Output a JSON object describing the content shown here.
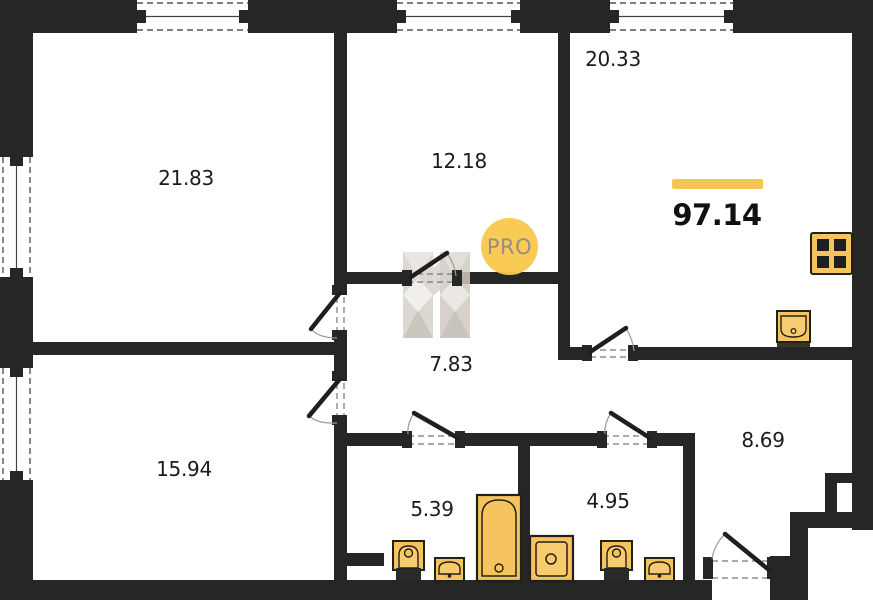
{
  "plan": {
    "total_area": "97.14",
    "accent_color": "#F6C452",
    "wall_color": "#262626",
    "fixture_color": "#F6C45E",
    "watermark": {
      "label": "PRO",
      "circle_color": "#F9C94F",
      "text_color": "#938B7B",
      "house_icon_color": "#D7D2CA"
    },
    "rooms": [
      {
        "name": "living-room",
        "area": "21.83"
      },
      {
        "name": "bedroom",
        "area": "12.18"
      },
      {
        "name": "kitchen-living",
        "area": "20.33"
      },
      {
        "name": "hallway",
        "area": "7.83"
      },
      {
        "name": "bedroom-2",
        "area": "15.94"
      },
      {
        "name": "bathroom",
        "area": "5.39"
      },
      {
        "name": "bathroom-2",
        "area": "4.95"
      },
      {
        "name": "entrance-hall",
        "area": "8.69"
      }
    ],
    "fixtures": [
      "toilet-icon",
      "sink-icon",
      "bathtub-icon",
      "washing-machine-icon",
      "toilet-icon",
      "sink-icon",
      "kitchen-sink-icon",
      "stove-icon"
    ]
  }
}
